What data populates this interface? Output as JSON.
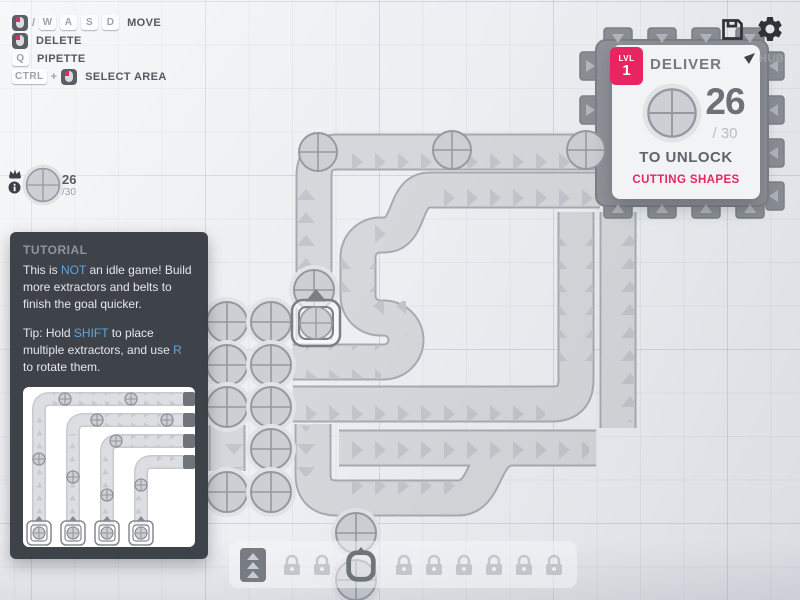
{
  "hud": {
    "hotkeys": {
      "slash": "/",
      "plus": "+",
      "rows": [
        {
          "label": "MOVE",
          "keycaps": [
            "W",
            "A",
            "S",
            "D"
          ]
        },
        {
          "label": "DELETE",
          "keycaps": []
        },
        {
          "label": "PIPETTE",
          "keycaps": [
            "Q"
          ]
        },
        {
          "label": "SELECT AREA",
          "keycaps": [
            "CTRL"
          ]
        }
      ]
    },
    "pin_counter": {
      "value": "26",
      "total": "/30"
    }
  },
  "goal_panel": {
    "level_badge": "LVL",
    "level_number": "1",
    "title": "DELIVER",
    "amount": "26",
    "of_total": "/ 30",
    "unlock_label": "TO UNLOCK",
    "reward": "CUTTING SHAPES",
    "accent_color": "#e82560"
  },
  "hub": {
    "marker_label": "HUB"
  },
  "tutorial": {
    "header": "TUTORIAL",
    "p1_pre": "This is ",
    "p1_hl": "NOT",
    "p1_post": " an idle game! Build more extractors and belts to finish the goal quicker.",
    "p2_pre": "Tip: Hold ",
    "p2_hl1": "SHIFT",
    "p2_mid": " to place multiple extractors, and use ",
    "p2_hl2": "R",
    "p2_post": " to rotate them.",
    "highlight_color": "#64a3da"
  },
  "toolbar": {
    "slots": [
      "belt",
      "lock",
      "lock",
      "extractor-selected",
      "lock",
      "lock",
      "lock",
      "lock",
      "lock",
      "lock"
    ]
  },
  "map": {
    "resource_shape": "circle",
    "delivered_shape": "circle"
  }
}
